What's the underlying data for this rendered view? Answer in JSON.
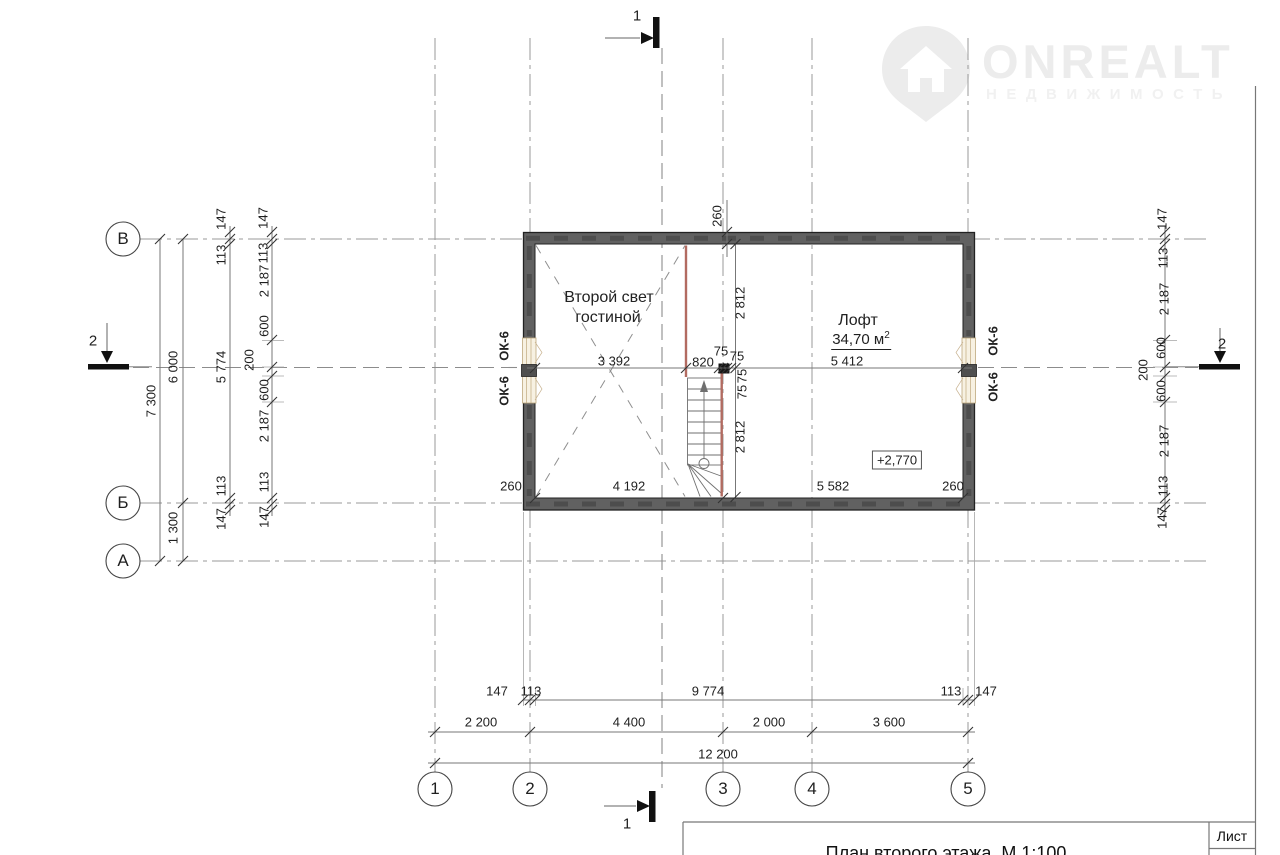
{
  "watermark": {
    "brand": "ONREALT",
    "subtitle": "НЕДВИЖИМОСТЬ",
    "icon": "house-pin-icon"
  },
  "axes": {
    "rows": [
      "В",
      "Б",
      "А"
    ],
    "cols": [
      "1",
      "2",
      "3",
      "4",
      "5"
    ]
  },
  "sections": {
    "s1": "1",
    "s2": "2"
  },
  "rooms": {
    "void_line1": "Второй свет",
    "void_line2": "гостиной",
    "loft_name": "Лофт",
    "loft_area": "34,70 м",
    "loft_area_exp": "2"
  },
  "marks": {
    "elevation": "+2,770",
    "window": "ОК-6",
    "wall_thickness": "260"
  },
  "dims": {
    "h": {
      "a": "3 392",
      "b": "820",
      "c": "5 412",
      "p75": "75"
    },
    "v": {
      "up": "2 812",
      "down": "2 812"
    },
    "inner_bottom": [
      "260",
      "4 192",
      "5 582",
      "260"
    ],
    "left_total": "7 300",
    "left2a": "6 000",
    "left2b": "1 300",
    "left3": [
      "147",
      "113",
      "5 774",
      "113",
      "147"
    ],
    "win_chain": [
      "147",
      "113",
      "2 187",
      "600",
      "200",
      "600",
      "2 187",
      "113",
      "147"
    ],
    "bottom1": [
      "147",
      "113",
      "9 774",
      "113",
      "147"
    ],
    "bottom2": [
      "2 200",
      "4 400",
      "2 000",
      "3 600"
    ],
    "bottom3": "12 200"
  },
  "title_block": {
    "title": "План второго этажа. М 1:100",
    "sheet": "Лист"
  },
  "colors": {
    "railing": "#b26b61",
    "wall": "#616161",
    "window_fill": "#f7f1e2",
    "watermark": "#ececec"
  }
}
